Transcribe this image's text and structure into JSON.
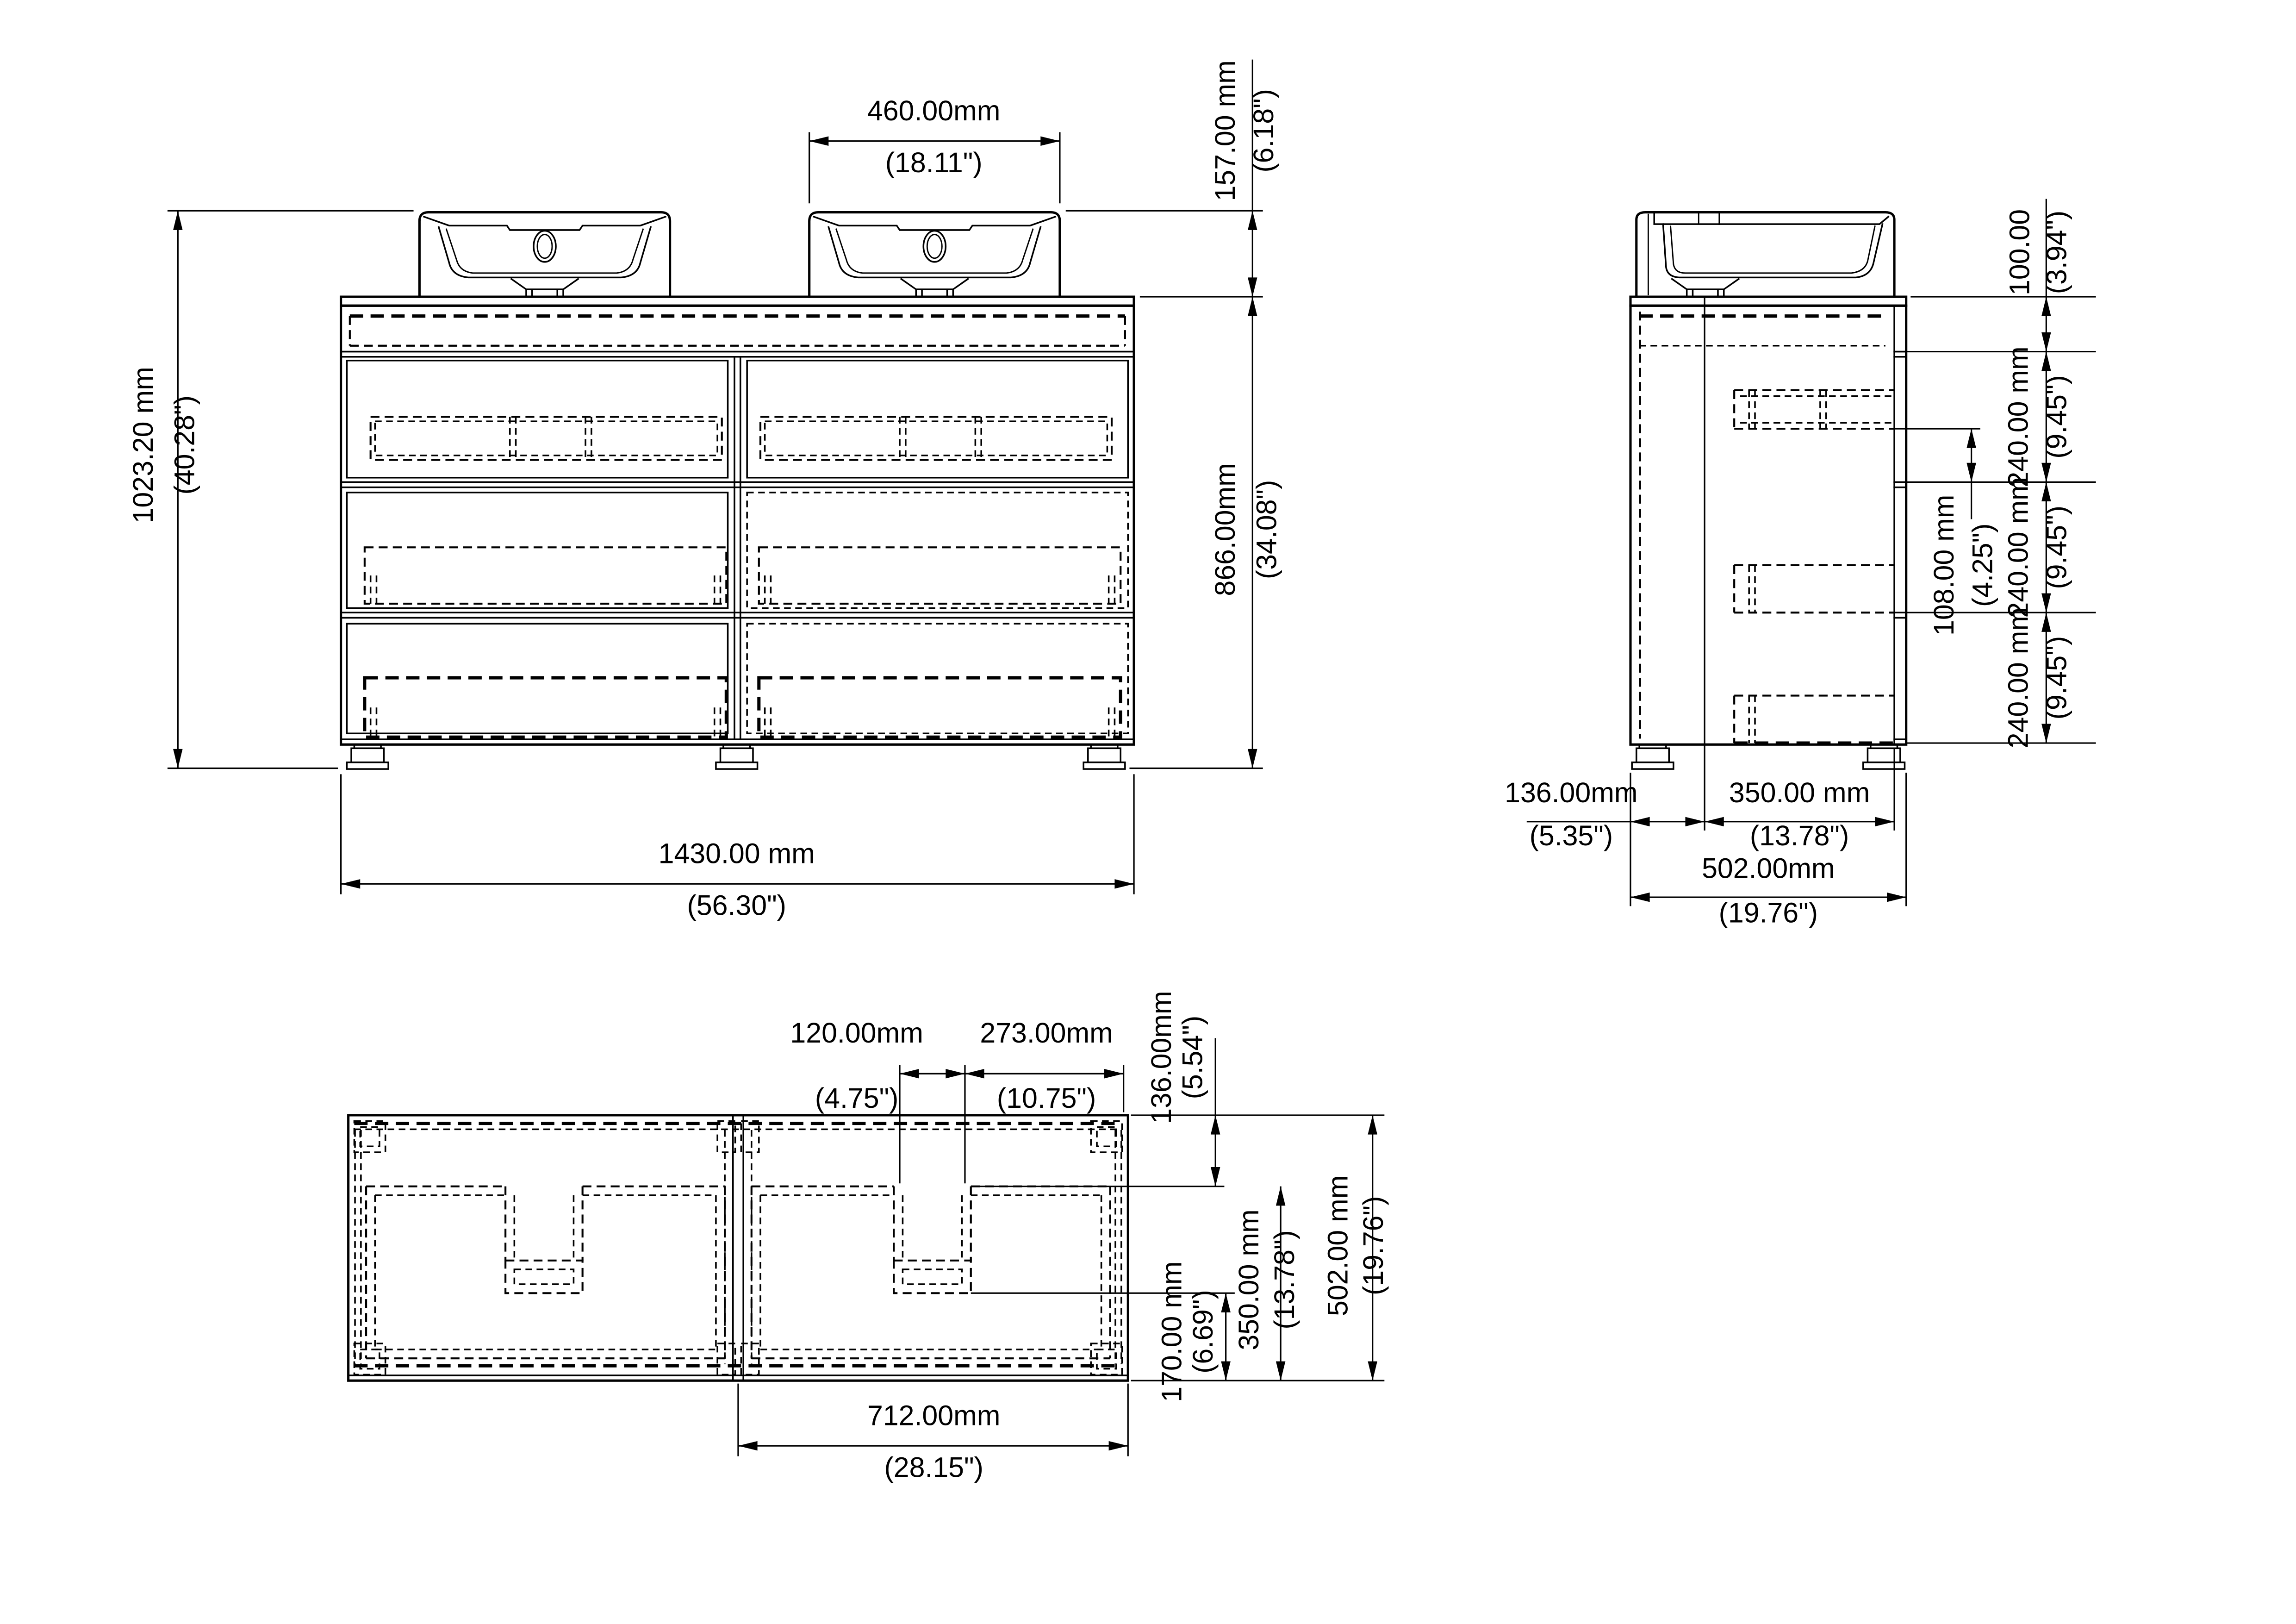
{
  "drawing_type": "furniture-dimension-drawing",
  "subject": "double-sink bathroom vanity cabinet with three drawers",
  "colors": {
    "line": "#000000",
    "background": "#ffffff"
  },
  "views": {
    "front": {
      "name": "front-view",
      "dims": {
        "sink_width": {
          "mm": "460.00mm",
          "in": "(18.11\")"
        },
        "sink_height": {
          "mm": "157.00 mm",
          "in": "(6.18\")"
        },
        "overall_height": {
          "mm": "1023.20 mm",
          "in": "(40.28\")"
        },
        "cabinet_height": {
          "mm": "866.00mm",
          "in": "(34.08\")"
        },
        "cabinet_width": {
          "mm": "1430.00 mm",
          "in": "(56.30\")"
        }
      }
    },
    "side": {
      "name": "side-view",
      "dims": {
        "top_rail": {
          "mm": "100.00",
          "in": "(3.94\")"
        },
        "drawer_top": {
          "mm": "240.00 mm",
          "in": "(9.45\")"
        },
        "handle_gap": {
          "mm": "108.00 mm",
          "in": "(4.25\")"
        },
        "drawer_middle": {
          "mm": "240.00 mm",
          "in": "(9.45\")"
        },
        "drawer_bottom": {
          "mm": "240.00 mm",
          "in": "(9.45\")"
        },
        "back_to_drain": {
          "mm": "136.00mm",
          "in": "(5.35\")"
        },
        "drain_to_front": {
          "mm": "350.00 mm",
          "in": "(13.78\")"
        },
        "depth": {
          "mm": "502.00mm",
          "in": "(19.76\")"
        }
      }
    },
    "top": {
      "name": "top-view",
      "dims": {
        "cutout_width": {
          "mm": "120.00mm",
          "in": "(4.75\")"
        },
        "cutout_to_edge": {
          "mm": "273.00mm",
          "in": "(10.75\")"
        },
        "back_to_cutout": {
          "mm": "136.00mm",
          "in": "(5.54\")"
        },
        "cutout_to_front": {
          "mm": "350.00 mm",
          "in": "(13.78\")"
        },
        "depth": {
          "mm": "502.00 mm",
          "in": "(19.76\")"
        },
        "cutout_front_gap": {
          "mm": "170.00 mm",
          "in": "(6.69\")"
        },
        "half_width": {
          "mm": "712.00mm",
          "in": "(28.15\")"
        }
      }
    }
  }
}
